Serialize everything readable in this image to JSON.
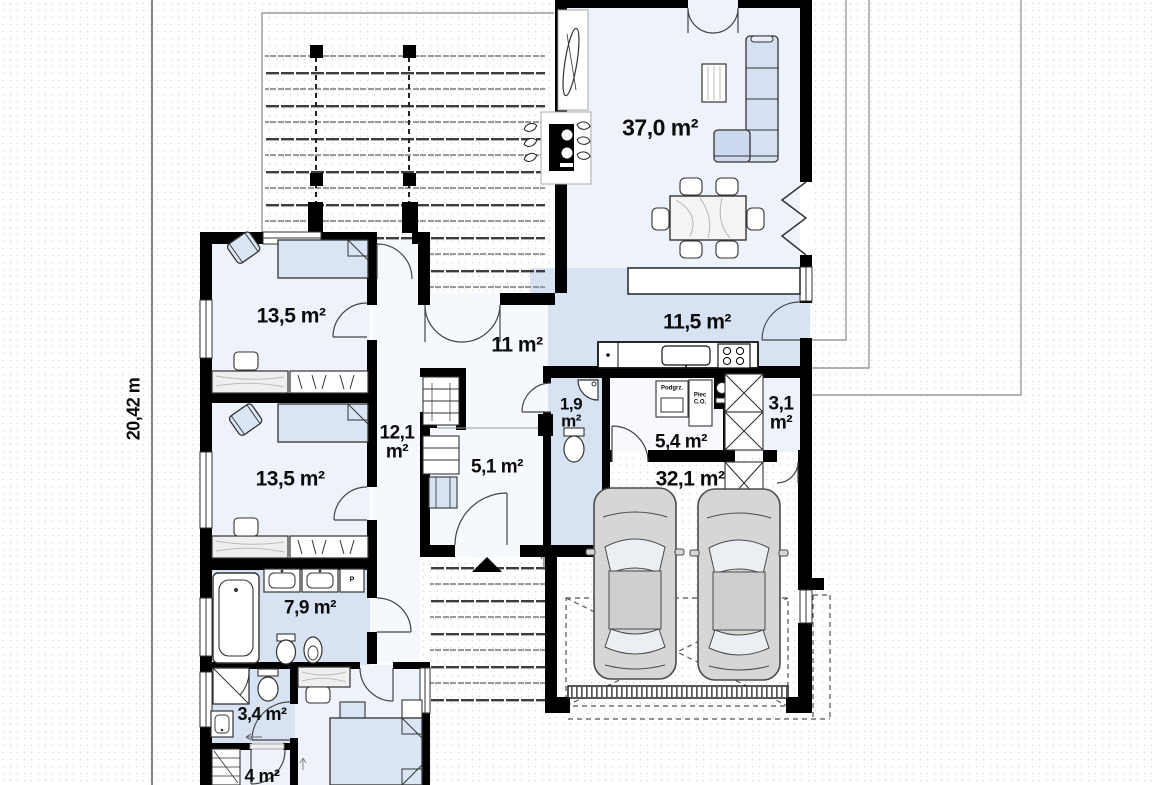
{
  "floorplan": {
    "dimension_label": "20,42 m",
    "rooms": {
      "living": {
        "area": "37,0 m²"
      },
      "kitchen": {
        "area": "11,5 m²"
      },
      "hall": {
        "area": "11 m²"
      },
      "bedroom1": {
        "area": "13,5 m²"
      },
      "bedroom2": {
        "area": "13,5 m²"
      },
      "corridor": {
        "area": "12,1 m²"
      },
      "wc": {
        "area": "1,9 m²"
      },
      "boiler_room": {
        "area": "5,4 m²"
      },
      "closet": {
        "area": "3,1 m²"
      },
      "vestibule": {
        "area": "5,1 m²"
      },
      "garage": {
        "area": "32,1 m²"
      },
      "bathroom": {
        "area": "7,9 m²"
      },
      "shower_room": {
        "area": "3,4 m²"
      },
      "wardrobe_room": {
        "area": "4 m²"
      }
    },
    "equipment": {
      "towel_cabinet": "P",
      "water_heater": "Podgrz.",
      "boiler": "Piec C.O."
    },
    "colors": {
      "wall": "#000000",
      "wet_room_fill": "#d7e2f2",
      "room_fill": "#eef2fa",
      "furniture_fill": "#d9e4f4"
    }
  }
}
